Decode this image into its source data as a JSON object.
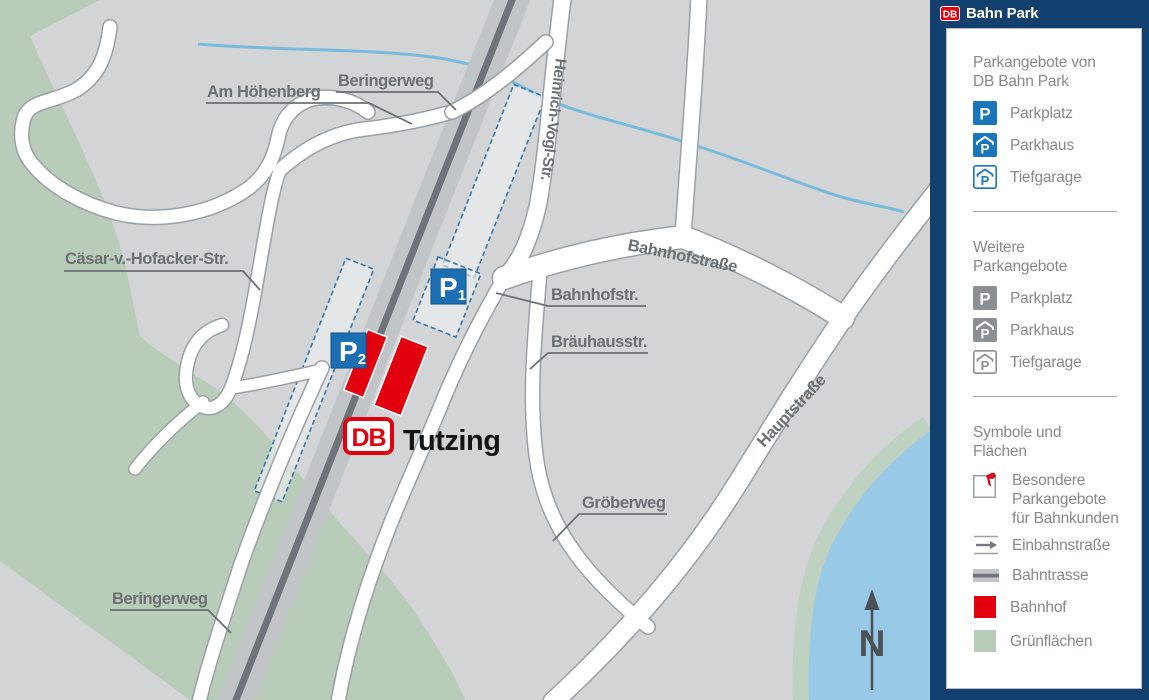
{
  "header": {
    "logo_text": "DB",
    "title": "Bahn Park"
  },
  "legend": {
    "db_offers": {
      "title_line1": "Parkangebote von",
      "title_line2": "DB Bahn Park",
      "icon_letter": "P",
      "items": [
        {
          "icon": "parkplatz-blue-icon",
          "label": "Parkplatz"
        },
        {
          "icon": "parkhaus-blue-icon",
          "label": "Parkhaus"
        },
        {
          "icon": "tiefgarage-blue-icon",
          "label": "Tiefgarage"
        }
      ]
    },
    "other_offers": {
      "title_line1": "Weitere",
      "title_line2": "Parkangebote",
      "icon_letter": "P",
      "items": [
        {
          "icon": "parkplatz-gray-icon",
          "label": "Parkplatz"
        },
        {
          "icon": "parkhaus-gray-icon",
          "label": "Parkhaus"
        },
        {
          "icon": "tiefgarage-gray-icon",
          "label": "Tiefgarage"
        }
      ]
    },
    "symbols": {
      "title_line1": "Symbole und",
      "title_line2": "Flächen",
      "items": [
        {
          "icon": "special-offers-icon",
          "label": "Besondere Parkangebote für Bahnkunden"
        },
        {
          "icon": "one-way-icon",
          "label": "Einbahnstraße"
        },
        {
          "icon": "railway-icon",
          "label": "Bahntrasse"
        },
        {
          "icon": "station-icon",
          "label": "Bahnhof"
        },
        {
          "icon": "green-area-icon",
          "label": "Grünflächen"
        }
      ]
    }
  },
  "map": {
    "station_logo": "DB",
    "station_name": "Tutzing",
    "north_label": "N",
    "markers": [
      {
        "label": "P",
        "sub": "1"
      },
      {
        "label": "P",
        "sub": "2"
      }
    ],
    "streets": [
      "Am Höhenberg",
      "Beringerweg",
      "Heinrich-Vogl-Str.",
      "Bahnhofstraße",
      "Cäsar-v.-Hofacker-Str.",
      "Bahnhofstr.",
      "Bräuhausstr.",
      "Hauptstraße",
      "Gröberweg",
      "Beringerweg"
    ]
  },
  "colors": {
    "navy": "#12406e",
    "db_red": "#e2000f",
    "marker_blue": "#1c6fb2",
    "legend_blue": "#1a76ba",
    "map_gray": "#d2d4d6",
    "green": "#b9cbb9",
    "water": "#98cae8",
    "rail_dark": "#6f747a",
    "label_gray": "#6b7074"
  }
}
